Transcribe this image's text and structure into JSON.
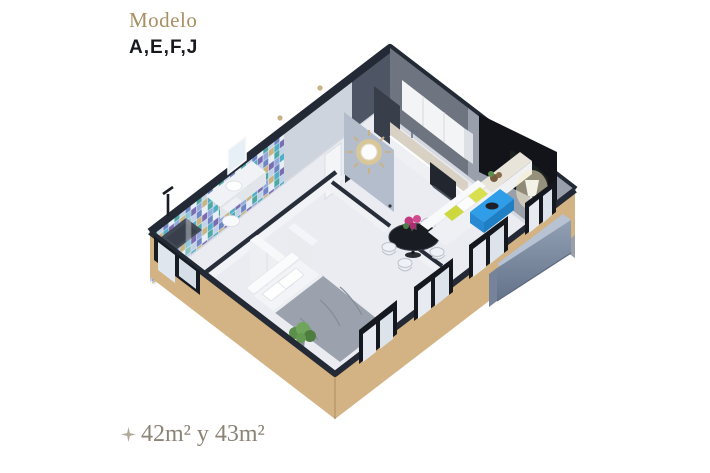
{
  "header": {
    "eyebrow": "Modelo",
    "models": "A,E,F,J"
  },
  "footer": {
    "area": "42m² y 43m²",
    "icon": "sparkle-icon"
  },
  "floorplan": {
    "colors": {
      "exterior_tan": "#d3b384",
      "wall_cap": "#232a35",
      "floor": "#eaecf2",
      "tv_screen": "#121419",
      "coffee_table_blue": "#2f9de8",
      "ledge_front": "#8493a8",
      "accent_gold": "#a79060",
      "area_text": "#8b8375",
      "pillow_yellow": "#d9e04f"
    }
  }
}
